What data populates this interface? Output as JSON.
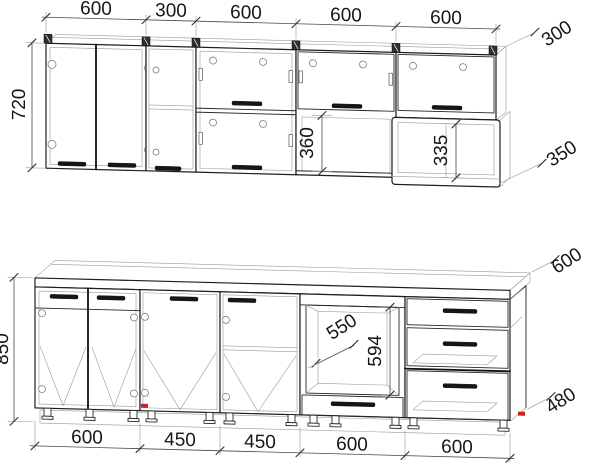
{
  "drawing": {
    "background": "#ffffff",
    "line_color": "#1e1e1e",
    "accent_red": "#c9241f",
    "type": "kitchen-cabinet-dimensioned-elevation"
  },
  "upper_row": {
    "height": "720",
    "widths": [
      "600",
      "300",
      "600",
      "600",
      "600"
    ],
    "cabinet_depth": "300",
    "open_shelf_depth": "350",
    "open_niche_height": "360",
    "shelf_inner_height": "335"
  },
  "base_row": {
    "height": "850",
    "widths": [
      "600",
      "450",
      "450",
      "600",
      "600"
    ],
    "worktop_depth": "600",
    "cabinet_depth": "480",
    "niche_width": "550",
    "niche_height": "594"
  }
}
